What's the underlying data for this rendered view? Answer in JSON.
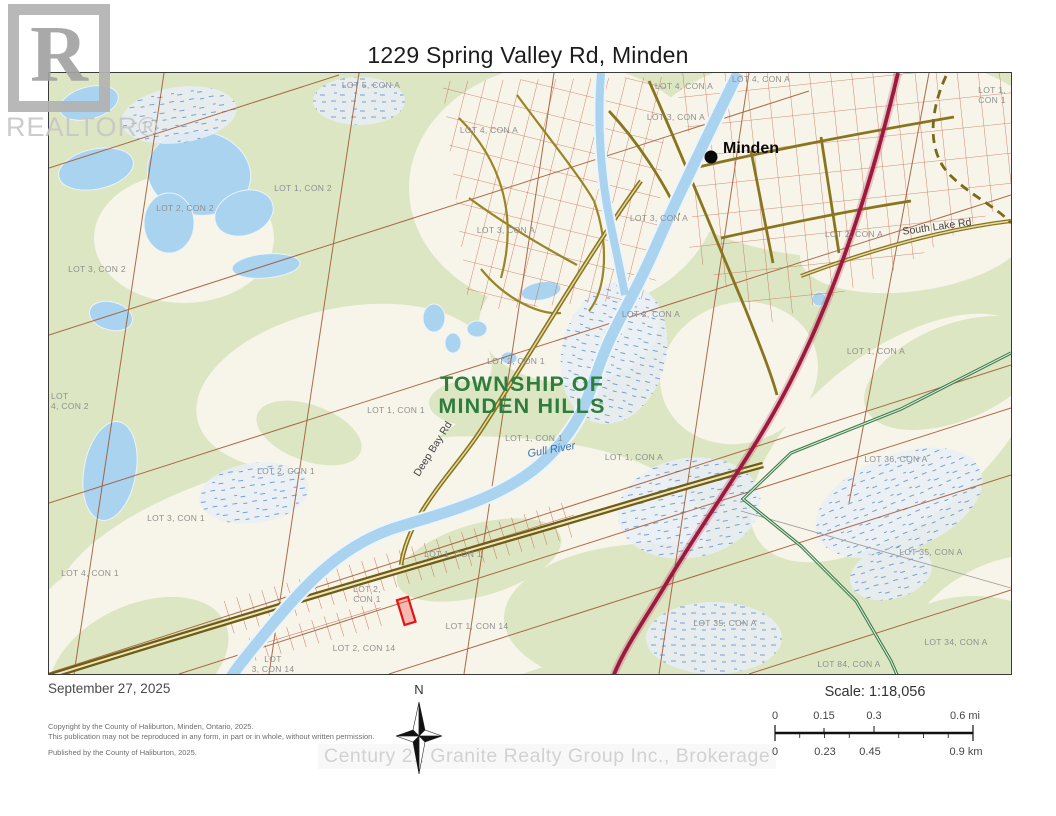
{
  "page": {
    "title": "1229 Spring Valley Rd, Minden"
  },
  "logo": {
    "letter": "R",
    "wordmark": "REALTOR®"
  },
  "map": {
    "township_line1": "TOWNSHIP OF",
    "township_line2": "MINDEN HILLS",
    "town_name": "Minden",
    "river_name": "Gull River",
    "road_names": {
      "deep_bay": "Deep Bay Rd",
      "south_lake": "South Lake Rd"
    },
    "lot_labels": [
      "LOT 5, CON A",
      "LOT 4, CON A",
      "LOT 1, CON 2",
      "LOT 2, CON 2",
      "LOT 3, CON 2",
      "LOT 4, CON A",
      "LOT 4, CON A",
      "LOT 3, CON A",
      "LOT 3, CON A",
      "LOT 3, CON A",
      "LOT 2, CON A",
      "LOT 1,",
      "CON 1",
      "LOT 2, CON A",
      "LOT 1, CON A",
      "LOT 2, CON 1",
      "LOT 1, CON 1",
      "LOT 1, CON 1",
      "LOT 1, CON A",
      "LOT 36, CON A",
      "LOT 2, CON 1",
      "LOT 3, CON 1",
      "LOT 4, CON 1",
      "LOT",
      "4, CON 2",
      "LOT 1, CON 1",
      "LOT 2,",
      "CON 1",
      "LOT 1, CON 14",
      "LOT 2, CON 14",
      "LOT",
      "3, CON 14",
      "LOT 35, CON A",
      "LOT 35, CON A",
      "LOT 34, CON A",
      "LOT 84, CON A"
    ],
    "colors": {
      "land_green": "#dce6c3",
      "cleared_ivory": "#f7f5ea",
      "water_blue": "#a9d3ef",
      "lot_line_brown": "#a0522d",
      "parcel_red": "#c3573b",
      "road_olive": "#8a751f",
      "highway_maroon": "#9c1a3e",
      "trail_green": "#3b7c4d",
      "township_green": "#2f7d3c",
      "subject_red": "#e01616"
    }
  },
  "footer": {
    "date": "September 27, 2025",
    "copyright_line1": "Copyright by the County of Haliburton, Minden, Ontario, 2025.",
    "copyright_line2": "This publication may not be reproduced in any form, in part or in whole, without written permission.",
    "published": "Published by the County of Haliburton, 2025.",
    "north_label": "N",
    "scale_text": "Scale: 1:18,056",
    "scale_mi": [
      "0",
      "0.15",
      "0.3",
      "0.6 mi"
    ],
    "scale_km": [
      "0",
      "0.23",
      "0.45",
      "0.9 km"
    ],
    "watermark": "Century 21 Granite Realty Group Inc., Brokerage"
  }
}
